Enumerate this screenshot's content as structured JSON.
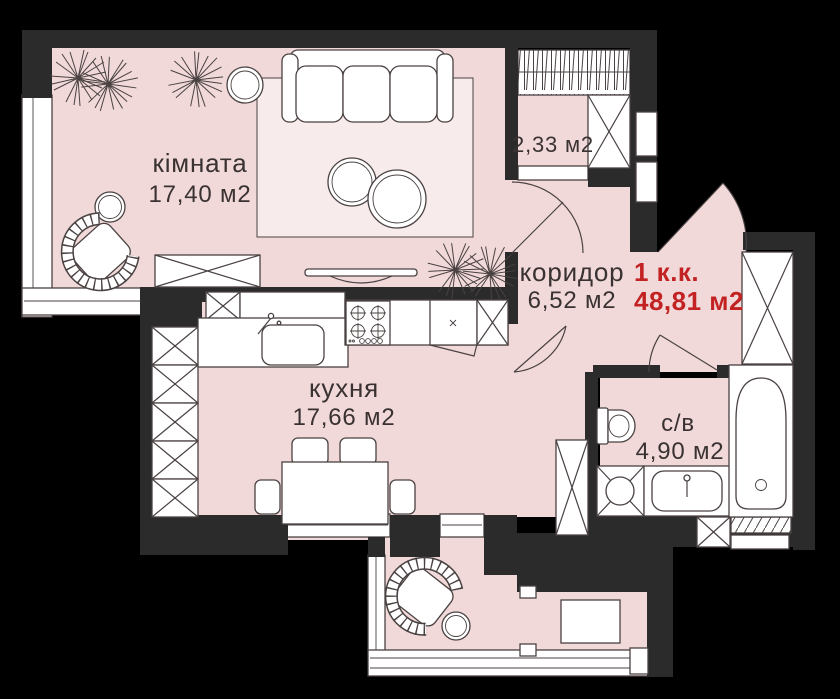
{
  "meta": {
    "kind": "apartment-floor-plan"
  },
  "colors": {
    "background": "#000000",
    "wall": "#2b2b2b",
    "floor": "#f1d9d9",
    "rug": "#f8ebeb",
    "furniture": "#ffffff",
    "outline": "#4a4242",
    "label_text": "#3a3232",
    "accent_red": "#c32222"
  },
  "summary": {
    "type_label": "1 к.к.",
    "total_area": "48,81 м2"
  },
  "rooms": [
    {
      "key": "living-room",
      "name": "кімната",
      "area": "17,40 м2"
    },
    {
      "key": "balcony-top",
      "area": "2,33 м2"
    },
    {
      "key": "corridor",
      "name": "коридор",
      "area": "6,52 м2"
    },
    {
      "key": "kitchen",
      "name": "кухня",
      "area": "17,66 м2"
    },
    {
      "key": "bathroom",
      "name": "с/в",
      "area": "4,90 м2"
    }
  ]
}
